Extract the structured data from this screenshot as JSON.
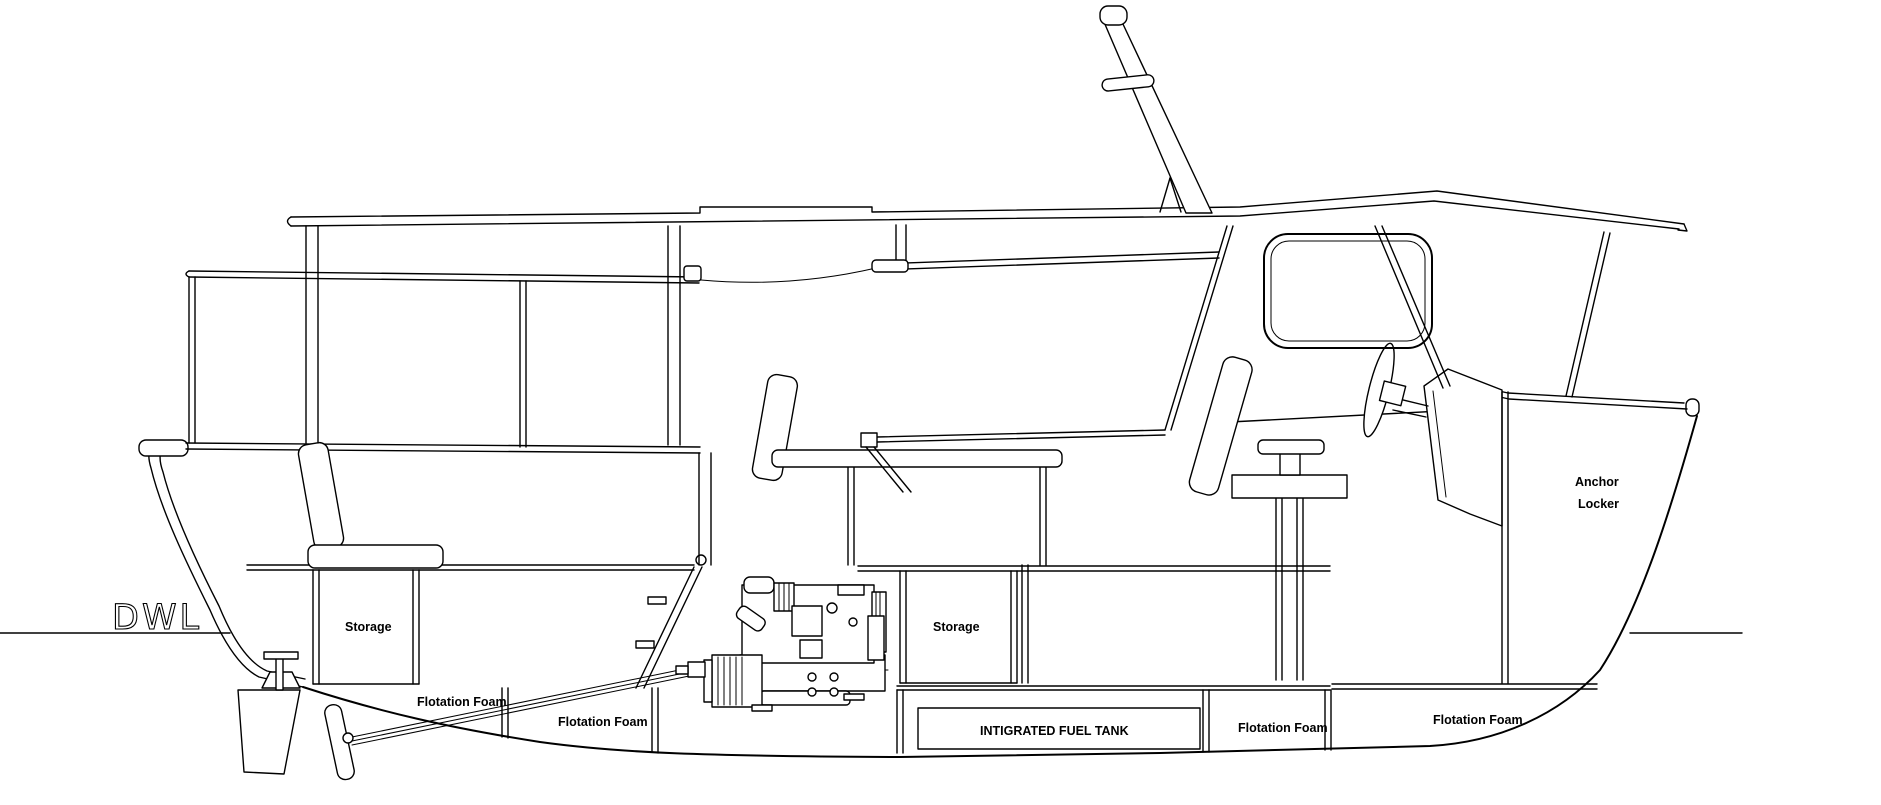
{
  "drawing": {
    "type": "boat-side-profile-cutaway",
    "background_color": "#ffffff",
    "line_color": "#000000",
    "waterline": {
      "label": "DWL"
    },
    "labels": {
      "storage_aft": "Storage",
      "storage_mid": "Storage",
      "flotation_foam_aft_upper": "Flotation Foam",
      "flotation_foam_aft_lower": "Flotation Foam",
      "fuel_tank": "INTIGRATED FUEL TANK",
      "flotation_foam_mid": "Flotation Foam",
      "flotation_foam_bow": "Flotation Foam",
      "anchor_locker_line1": "Anchor",
      "anchor_locker_line2": "Locker"
    }
  }
}
